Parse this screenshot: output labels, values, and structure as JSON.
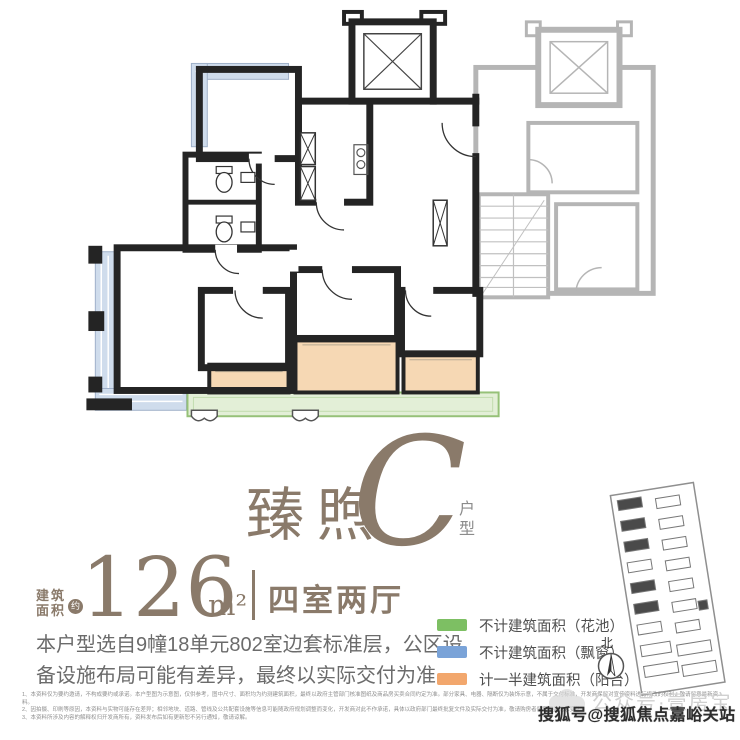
{
  "palette": {
    "accent": "#8a7a6a",
    "text_gray": "#6b6b6b",
    "fine_print_gray": "#8f8f8f"
  },
  "title": {
    "name": "臻煦",
    "letter": "C",
    "suffix": "户型"
  },
  "area": {
    "label_line1": "建筑",
    "label_line2": "面积",
    "badge": "约",
    "value": "126",
    "unit": "m²",
    "rooms": "四室两厅"
  },
  "description": {
    "line1": "本户型选自9幢18单元802室边套标准层，公区设",
    "line2": "备设施布局可能有差异，最终以实际交付为准"
  },
  "legend": {
    "items": [
      {
        "label": "不计建筑面积（花池）",
        "color": "#7dbf63"
      },
      {
        "label": "不计建筑面积（飘窗）",
        "color": "#7aa3d8"
      },
      {
        "label": "计一半建筑面积（阳台）",
        "color": "#f2a76d"
      }
    ]
  },
  "compass": {
    "label": "北"
  },
  "watermarks": {
    "light": "公众号·壹房宝",
    "dark": "搜狐号@搜狐焦点嘉峪关站"
  },
  "fine_print": {
    "lines": [
      "1、本资料仅为要约邀请，不构成要约或承诺。本户型图为示意图，仅供参考，图中尺寸、面积均为约测建筑面积，最终以政府主管部门核准图纸及商品房买卖合同约定为准。部分家具、电器、隔断仅为装饰示意，不属于交付标准，开发商保留对宣传资料进行修改的权利，敬请留意最新资料。",
      "2、因拍摄、印刷等原因，本资料与实物可能存在差异；相邻地块、道路、管线及公共配套设施等信息可能随政府规划调整而变化，开发商对此不作承诺，具体以政府部门最终批复文件及实际交付为准，敬请购房者留意相关信息变化。",
      "3、本资料所涉及内容的解释权归开发商所有，资料发布后如有更新恕不另行通知，敬请谅解。"
    ]
  },
  "floor_plan": {
    "colors": {
      "wall": "#242424",
      "neighbor": "#b5b5b5",
      "bay_window": "#cfdcec",
      "balcony": "#f6d8b4",
      "flower_bed": "#e3efd7",
      "flower_bed_border": "#96c178"
    }
  }
}
